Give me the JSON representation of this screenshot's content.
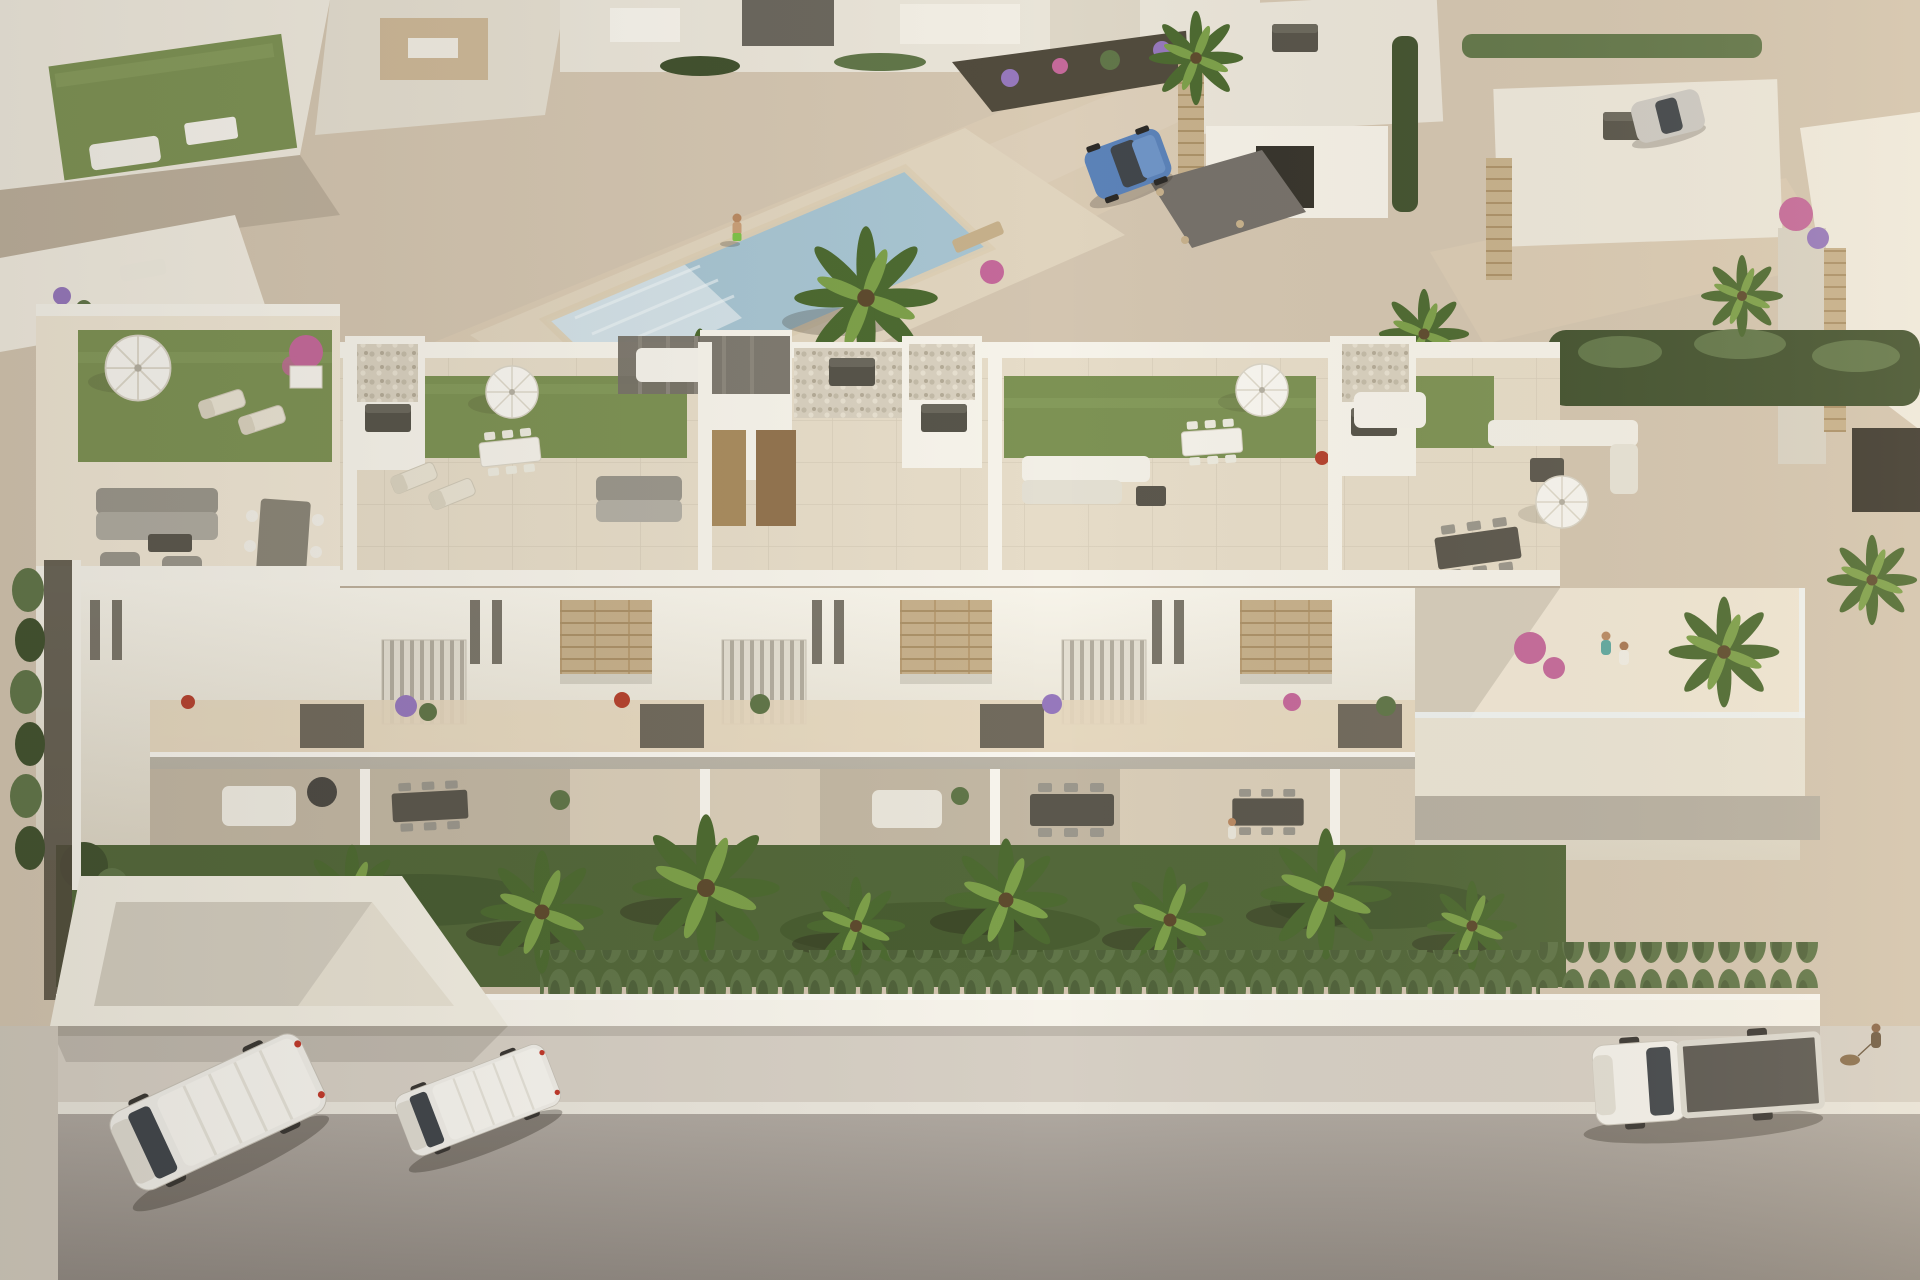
{
  "meta": {
    "type": "architectural-aerial-render",
    "description": "Aerial 3D render of a modern white Mediterranean residential development at golden hour: a row of townhouses with rooftop solarium terraces, private gardens with palms and a clipped hedge, a communal pool plaza behind, detached villas beyond, and a street in front with parked vehicles.",
    "lighting": "warm late-afternoon sun from the upper right casting soft shadows to the lower left"
  },
  "palette": {
    "plaza": "#d3c5b0",
    "walkway": "#d9cab3",
    "deck": "#e0d4be",
    "tile": "#e6dcc8",
    "tileLight": "#efe6d4",
    "wallWhite": "#f6f3ea",
    "wallShade": "#d9d3c5",
    "wallDark": "#bcb5a5",
    "stone": "#c6b08b",
    "stoneDark": "#a78e66",
    "grassRoof": "#7d9254",
    "grassRoofLight": "#8fa363",
    "lawn": "#53683a",
    "lawnDark": "#3d5029",
    "hedge": "#617649",
    "hedgeDark": "#42522f",
    "palm": "#4d6a31",
    "palmLight": "#7da04a",
    "soil": "#514b3d",
    "pool": "#d2e0e6",
    "poolDeep": "#a7c4d1",
    "road": "#a8a19a",
    "roadDark": "#8f8881",
    "sidewalk": "#d6cfc4",
    "curb": "#e8e4da",
    "furnGray": "#9b978c",
    "furnDark": "#5b574d",
    "wood": "#a98c5f",
    "strawTan": "#c8b286",
    "flowerPurple": "#9678bc",
    "flowerPink": "#c4699a",
    "flowerOrange": "#cd7f4a",
    "flowerRed": "#b5432f",
    "carBlue": "#5b82b8",
    "glass": "#41464b"
  },
  "scene": {
    "setting": "aerial view of a new-build residential complex",
    "background_elements": [
      "neighboring terraced homes with rooftop gardens",
      "communal swimming pool with steps and palm trees",
      "landscaped promenade with flowering borders",
      "detached villas with stone-clad pillars and roof AC units",
      "parked blue hatchback on gravel driveway",
      "parked silver car"
    ],
    "main_building": {
      "label": "row of townhouses with rooftop solariums",
      "rooftop_features": [
        "artificial grass lawns",
        "white parasols",
        "sun loungers",
        "outdoor lounge sofas",
        "dining sets",
        "stone-clad stair towers with pebble beds",
        "dark roof hatch boxes",
        "glass balustrade terrace"
      ],
      "facade_features": [
        "white rendered walls",
        "vertical slit windows",
        "louvered shade screens",
        "travertine accent panels",
        "balconies with flowering planters",
        "covered ground-floor terraces with dining sets and day beds"
      ]
    },
    "foreground": [
      "private lawns with palm trees",
      "clipped conical hedge row",
      "white boundary wall",
      "light concrete sidewalk",
      "asphalt street"
    ],
    "street_vehicles": [
      "white panel van",
      "white compact van",
      "white flatbed truck with dark cargo bed"
    ],
    "figures": [
      "man walking on pool promenade",
      "couple standing on roof terrace",
      "resident on ground-floor terrace",
      "pedestrian walking a dog on the sidewalk"
    ]
  }
}
